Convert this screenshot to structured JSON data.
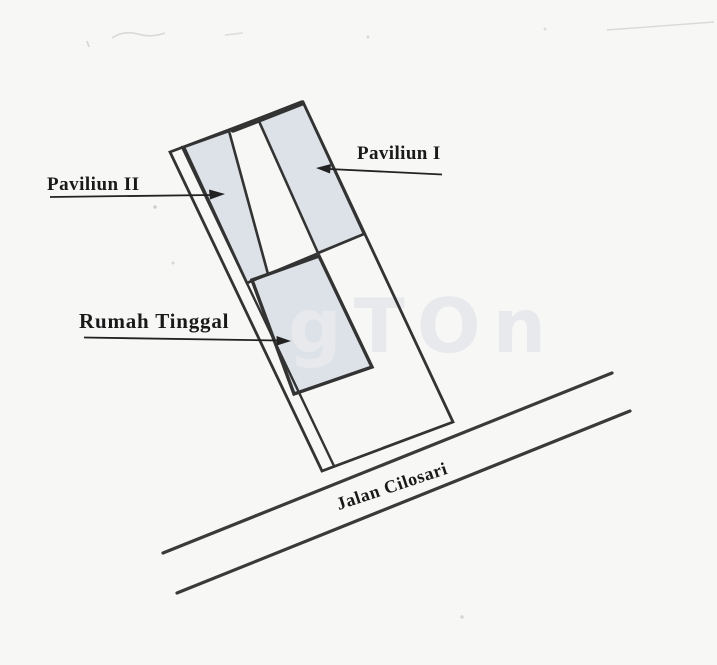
{
  "diagram": {
    "kind": "scanned-site-plan-sketch",
    "buildings": [
      {
        "id": "paviliun-1",
        "label": "Paviliun I",
        "shaded": true
      },
      {
        "id": "paviliun-2",
        "label": "Paviliun II",
        "shaded": true
      },
      {
        "id": "rumah-tinggal",
        "label": "Rumah Tinggal",
        "shaded": true
      }
    ],
    "road": {
      "name": "Jalan Cilosari"
    },
    "watermark": "gTOn",
    "colors": {
      "background": "#f7f7f5",
      "line": "#333333",
      "building_fill": "#dce2e7",
      "label_text": "#1a1a1a",
      "watermark": "#e7e9ec"
    }
  }
}
